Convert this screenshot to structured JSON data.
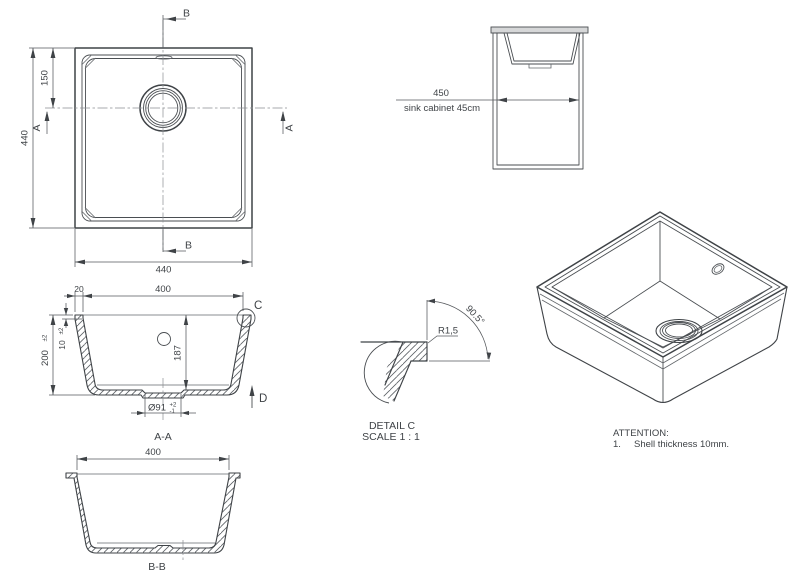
{
  "plan": {
    "dim_side_left": "440",
    "dim_bottom": "440",
    "dim_drain_offset": "150",
    "label_a_left": "A",
    "label_a_right": "A",
    "label_b_top": "B",
    "label_b_bottom": "B"
  },
  "cabinet": {
    "dim": "450",
    "caption": "sink cabinet 45cm"
  },
  "section_aa": {
    "label": "A-A",
    "dim_rim_width": "20",
    "dim_opening": "400",
    "dim_height": "200",
    "dim_height_tol": "±2",
    "dim_lip": "10",
    "dim_lip_tol": "±2",
    "dim_depth": "187",
    "dim_drain_dia": "Ø91",
    "dim_drain_tol_plus": "+2",
    "dim_drain_tol_minus": "-1",
    "detail_label": "C",
    "direction_label": "D"
  },
  "section_bb": {
    "label": "B-B",
    "dim_opening": "400"
  },
  "detail_c": {
    "title": "DETAIL C",
    "scale": "SCALE 1 : 1",
    "radius": "R1,5",
    "angle": "90.5°"
  },
  "notes": {
    "attention": "ATTENTION:",
    "item1_number": "1.",
    "item1_text": "Shell thickness 10mm."
  },
  "colors": {
    "line": "#3f4347",
    "line_thin": "#63676b",
    "centerline": "#8a8e93",
    "text": "#3f4347",
    "countertop_fill": "#d6d7d8",
    "background": "#ffffff"
  }
}
